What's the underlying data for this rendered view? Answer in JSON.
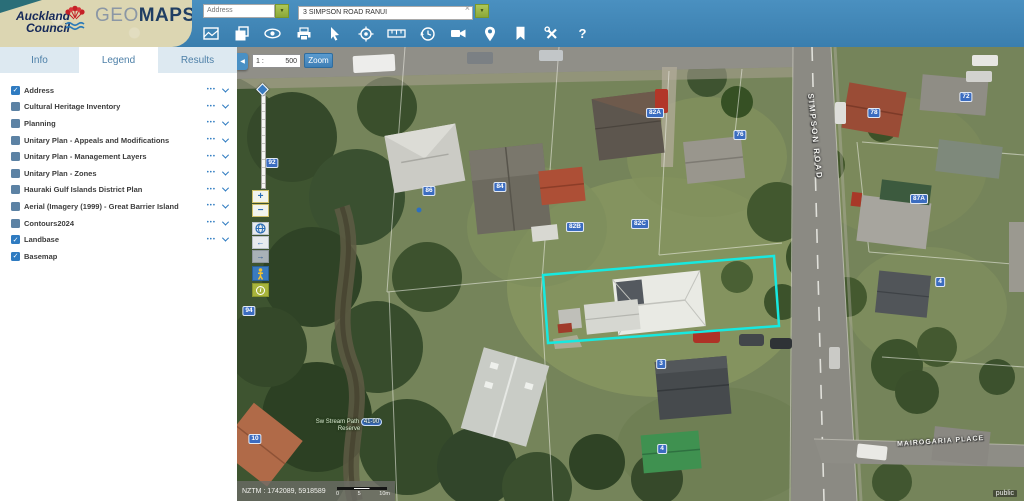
{
  "header": {
    "council_logo": {
      "line1": "Auckland",
      "line2": "Council"
    },
    "brand": {
      "geo": "GEO",
      "maps": "MAPS"
    },
    "search": {
      "category_value": "Address",
      "dropdown_glyph": "▼",
      "query_value": "3 SIMPSON ROAD RANUI",
      "clear_glyph": "×",
      "go_glyph": "▼"
    },
    "help_glyph": "?"
  },
  "sidebar": {
    "tabs": [
      {
        "label": "Info",
        "active": false
      },
      {
        "label": "Legend",
        "active": true
      },
      {
        "label": "Results",
        "active": false
      }
    ],
    "check_glyph": "✓",
    "menu_glyph": "•••",
    "layers": [
      {
        "label": "Address",
        "checked": true,
        "has_menu": true
      },
      {
        "label": "Cultural Heritage Inventory",
        "checked": false,
        "has_menu": true
      },
      {
        "label": "Planning",
        "checked": false,
        "has_menu": true
      },
      {
        "label": "Unitary Plan - Appeals and Modifications",
        "checked": false,
        "has_menu": true
      },
      {
        "label": "Unitary Plan - Management Layers",
        "checked": false,
        "has_menu": true
      },
      {
        "label": "Unitary Plan - Zones",
        "checked": false,
        "has_menu": true
      },
      {
        "label": "Hauraki Gulf Islands District Plan",
        "checked": false,
        "has_menu": true
      },
      {
        "label": "Aerial (Imagery (1999) - Great Barrier Island",
        "checked": false,
        "has_menu": true
      },
      {
        "label": "Contours2024",
        "checked": false,
        "has_menu": true
      },
      {
        "label": "Landbase",
        "checked": true,
        "has_menu": true
      },
      {
        "label": "Basemap",
        "checked": true,
        "has_menu": false
      }
    ]
  },
  "map": {
    "collapse_glyph": "◀",
    "scale_prefix": "1 :",
    "scale_value": "500",
    "zoom_button_label": "Zoom",
    "controls": {
      "zoom_in": "+",
      "zoom_out": "−",
      "back": "←",
      "forward": "→",
      "info": "i"
    },
    "road_labels": {
      "vertical": "SIMPSON ROAD",
      "bottom": "MAIROGARIA PLACE"
    },
    "reserve_label": {
      "line1": "Sw Stream Path",
      "badge": "41-90",
      "line2": "Reserve"
    },
    "house_numbers": [
      "92",
      "94",
      "86",
      "84",
      "82B",
      "82C",
      "82A",
      "76",
      "78",
      "72",
      "87A",
      "4",
      "3",
      "4",
      "10"
    ],
    "status": {
      "coords": "NZTM : 1742089, 5918589",
      "scalebar": [
        "0",
        "5",
        "10m"
      ]
    },
    "watermark": "public"
  },
  "colors": {
    "header_blue": "#3f86ba",
    "accent_green": "#9ab83f",
    "highlight_cyan": "#17e9e0",
    "pill_blue": "#3b6cc0"
  }
}
